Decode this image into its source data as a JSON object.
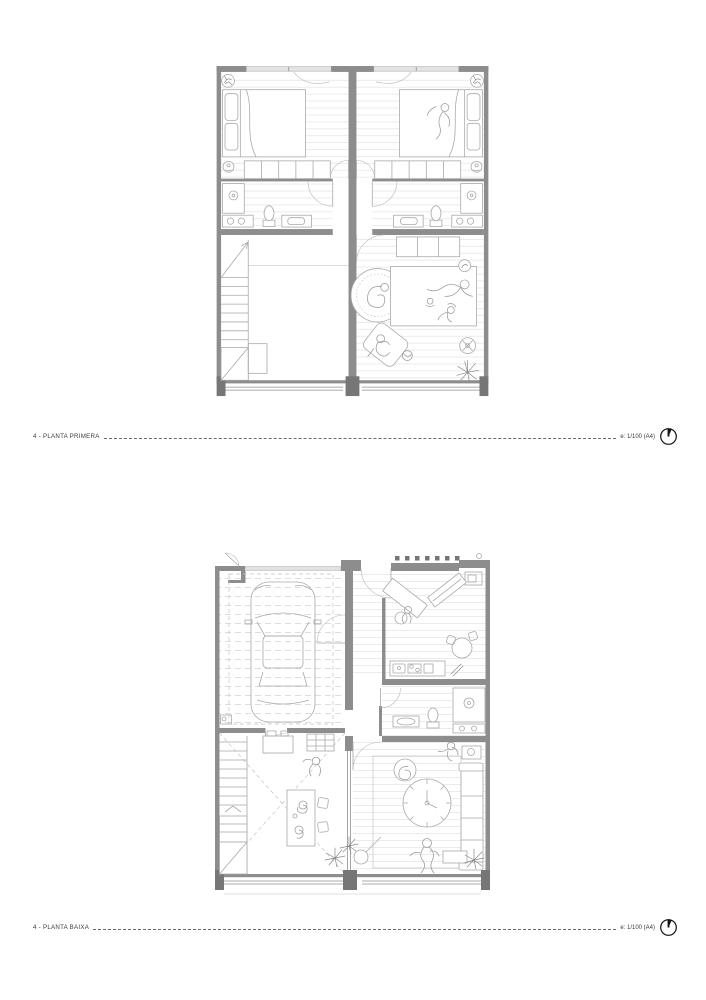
{
  "sheet": {
    "background": "#ffffff",
    "captions": [
      {
        "label": "4 - PLANTA PRIMERA",
        "scale_note": "e: 1/100 (A4)",
        "icon": "north-arrow-icon"
      },
      {
        "label": "4 - PLANTA BAIXA",
        "scale_note": "e: 1/100 (A4)",
        "icon": "north-arrow-icon"
      }
    ]
  },
  "colors": {
    "page_bg": "#ffffff",
    "wall": "#8d8d8d",
    "wall_dark": "#767676",
    "window_fill": "#e4e4e4",
    "floor_line": "#e3e3e3",
    "furniture_line": "#a9a9a9",
    "figure_line": "#9a9a9a",
    "dashed_guide": "#c4c4c4",
    "door_arc": "#b8b8b8",
    "caption_text": "#3c3c3c",
    "caption_line": "#6b6b6b",
    "north_icon": "#161616"
  }
}
